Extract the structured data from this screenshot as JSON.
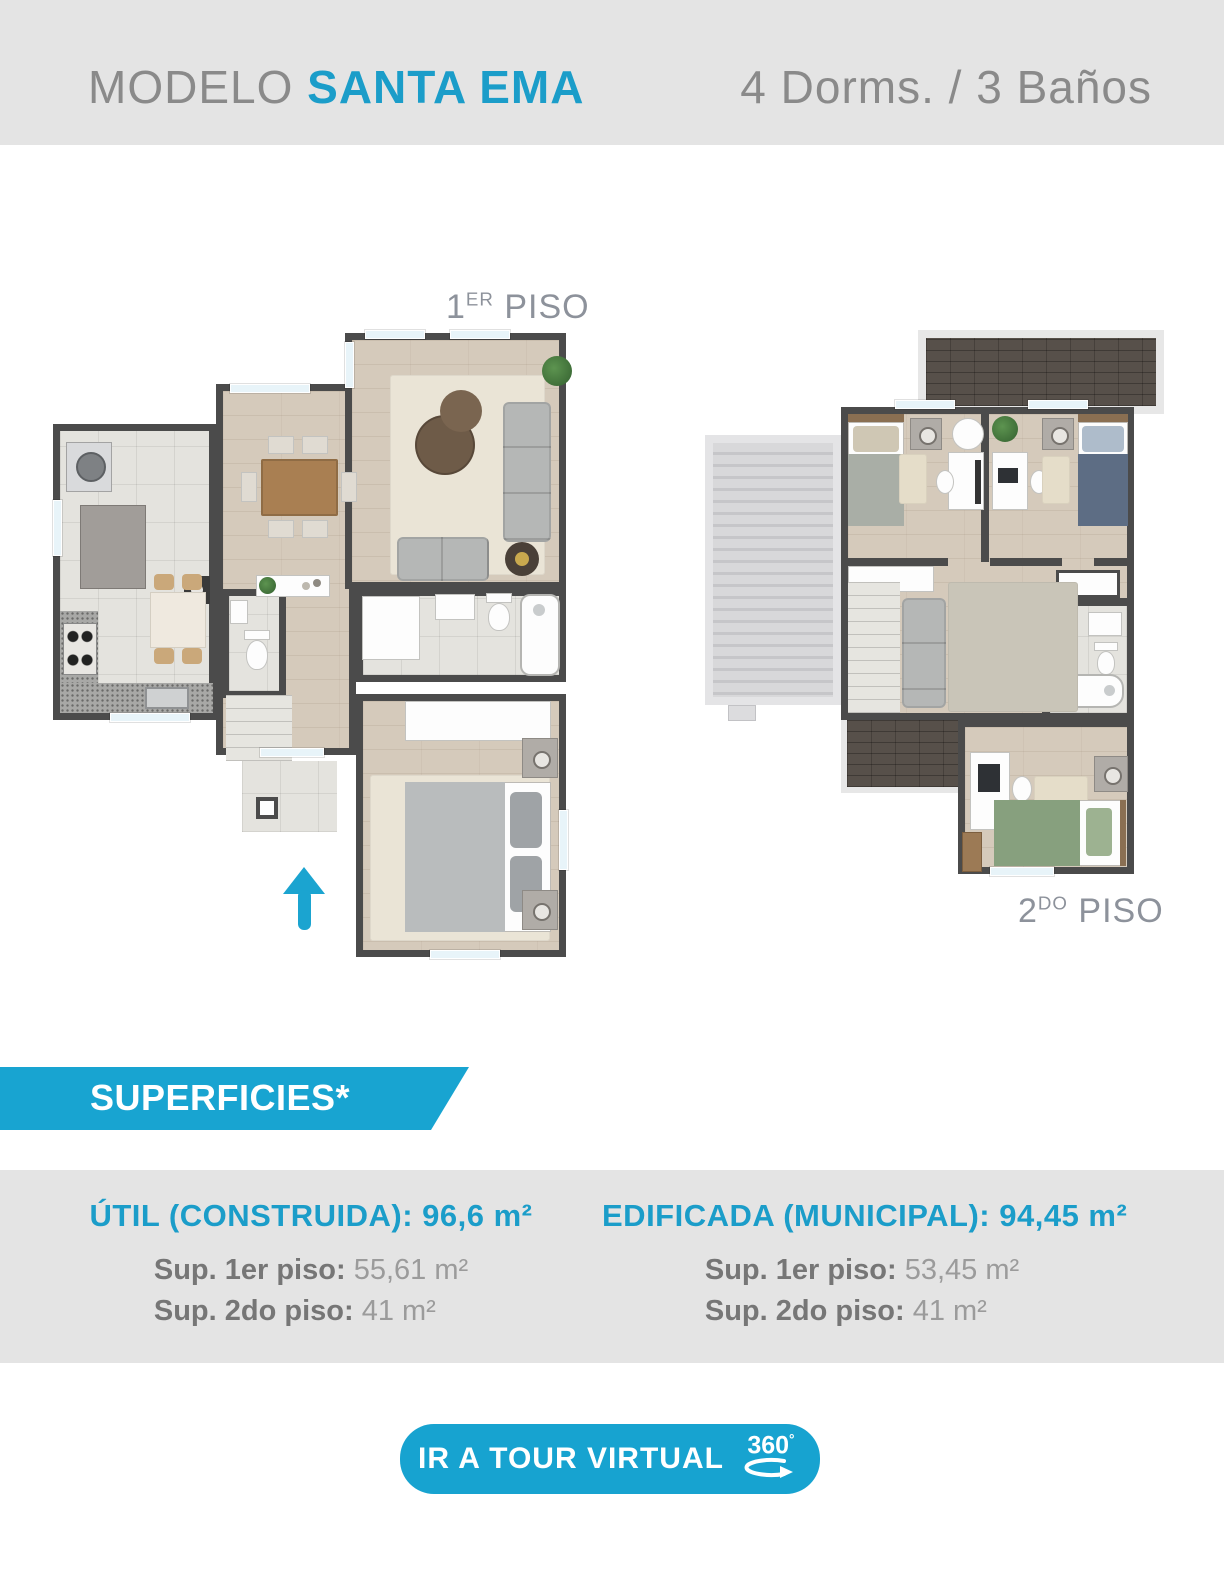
{
  "colors": {
    "accent_blue": "#1b9dc9",
    "banner_blue": "#18a4d1",
    "header_bg": "#e4e4e4",
    "band_bg": "#e4e4e4",
    "arrow_blue": "#1ba4d0",
    "wall": "#4b4b4b"
  },
  "header": {
    "model_prefix": "MODELO ",
    "model_name": "SANTA EMA",
    "specs": "4 Dorms. / 3 Baños"
  },
  "plans": {
    "first": {
      "label_number": "1",
      "label_ordinal": "ER",
      "label_word": " PISO"
    },
    "second": {
      "label_number": "2",
      "label_ordinal": "DO",
      "label_word": " PISO"
    }
  },
  "superficies": {
    "banner": "SUPERFICIES*"
  },
  "surfaces": {
    "left": {
      "title": "ÚTIL (CONSTRUIDA): 96,6 m²",
      "rows": [
        {
          "label": "Sup. 1er piso: ",
          "value": "55,61 m²"
        },
        {
          "label": "Sup. 2do piso: ",
          "value": "41 m²"
        }
      ]
    },
    "right": {
      "title": "EDIFICADA (MUNICIPAL): 94,45 m²",
      "rows": [
        {
          "label": "Sup. 1er piso: ",
          "value": "53,45 m²"
        },
        {
          "label": "Sup. 2do piso: ",
          "value": "41 m²"
        }
      ]
    }
  },
  "tour_button": {
    "label": "IR A TOUR VIRTUAL",
    "icon_text": "360",
    "icon_degree": "°"
  }
}
